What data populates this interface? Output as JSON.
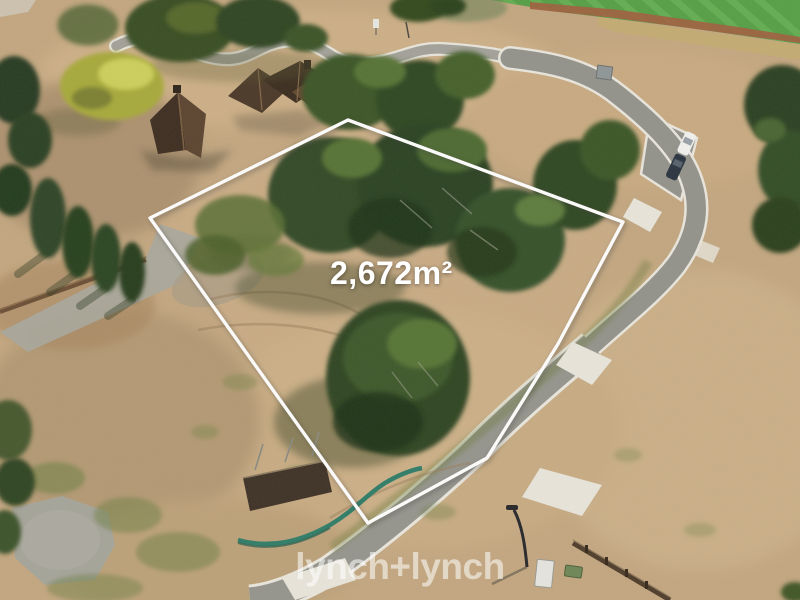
{
  "overlay": {
    "area_label": "2,672m²",
    "watermark": "lynch+lynch"
  },
  "colors": {
    "boundary_line": "#ffffff",
    "area_label_text": "#ffffff",
    "watermark_text": "rgba(255,255,255,0.55)",
    "dirt_ground": "#c3a781",
    "road_asphalt": "#93938c",
    "kerb_concrete": "#eae7de",
    "sports_field_green": "#55a046",
    "running_track_red": "#a05f3f",
    "tree_dark_green": "#2e4522",
    "golden_cypress": "#a7aa3a",
    "house_roof_brown": "#4a3828",
    "gravel_grey": "#a6a59b",
    "silt_fence_teal": "#2f7d68",
    "car_white": "#f2f2ef",
    "car_dark": "#2a3440"
  }
}
